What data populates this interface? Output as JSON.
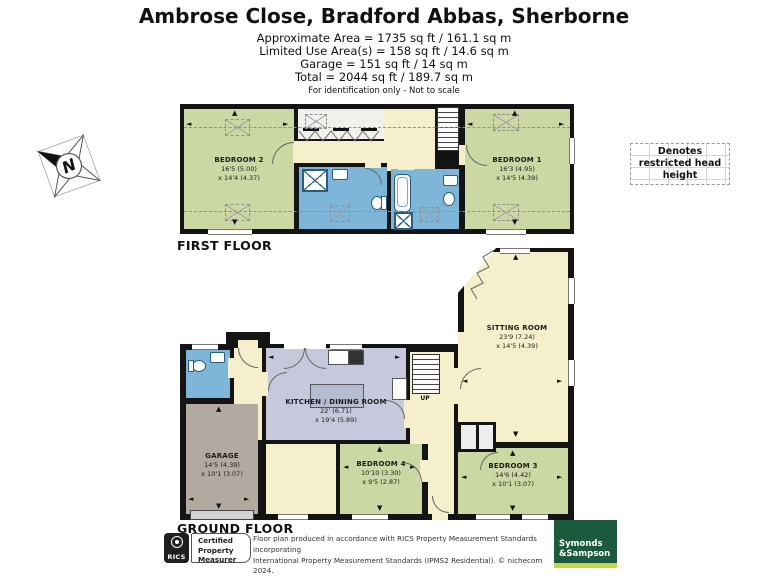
{
  "header": {
    "title": "Ambrose Close, Bradford Abbas, Sherborne",
    "area_lines": [
      "Approximate Area = 1735 sq ft / 161.1 sq m",
      "Limited Use Area(s) = 158 sq ft / 14.6 sq m",
      "Garage = 151 sq ft / 14 sq m",
      "Total = 2044 sq ft / 189.7 sq m"
    ],
    "note": "For identification only - Not to scale"
  },
  "compass": {
    "north": "N"
  },
  "legend": {
    "restricted": "Denotes restricted head height"
  },
  "first_floor": {
    "label": "FIRST FLOOR",
    "stairs": "DOWN",
    "rooms": {
      "bedroom2": {
        "name": "BEDROOM 2",
        "d1": "16'5 (5.00)",
        "d2": "x 14'4 (4.37)"
      },
      "bedroom1": {
        "name": "BEDROOM 1",
        "d1": "16'3 (4.95)",
        "d2": "x 14'5 (4.39)"
      }
    }
  },
  "ground_floor": {
    "label": "GROUND FLOOR",
    "stairs": "UP",
    "rooms": {
      "sitting": {
        "name": "SITTING ROOM",
        "d1": "23'9 (7.24)",
        "d2": "x 14'5 (4.39)"
      },
      "kitchen": {
        "name": "KITCHEN / DINING ROOM",
        "d1": "22' (6.71)",
        "d2": "x 19'4 (5.89)"
      },
      "garage": {
        "name": "GARAGE",
        "d1": "14'5 (4.39)",
        "d2": "x 10'1 (3.07)"
      },
      "bedroom4": {
        "name": "BEDROOM 4",
        "d1": "10'10 (3.30)",
        "d2": "x 9'5 (2.87)"
      },
      "bedroom3": {
        "name": "BEDROOM 3",
        "d1": "14'6 (4.42)",
        "d2": "x 10'1 (3.07)"
      }
    }
  },
  "footer": {
    "rics_brand": "RICS",
    "cert_lines": [
      "Certified",
      "Property",
      "Measurer"
    ],
    "disclaimer_lines": [
      "Floor plan produced in accordance with RICS Property Measurement Standards incorporating",
      "International Property Measurement Standards (IPMS2 Residential).   © nichecom 2024.",
      "Produced for Symonds & Sampson.   REF: 1141316"
    ],
    "agent": {
      "line1": "Symonds",
      "line2": "&Sampson"
    }
  },
  "colors": {
    "wall": "#141414",
    "bedroom_green": "#cbd8a4",
    "bathroom_blue": "#7db6d8",
    "hall_cream": "#f6efcc",
    "kitchen_lavender": "#c5c9db",
    "garage_taupe": "#b2a9a0",
    "agent_green": "#1c5a3e",
    "agent_lime": "#c6d63e"
  }
}
